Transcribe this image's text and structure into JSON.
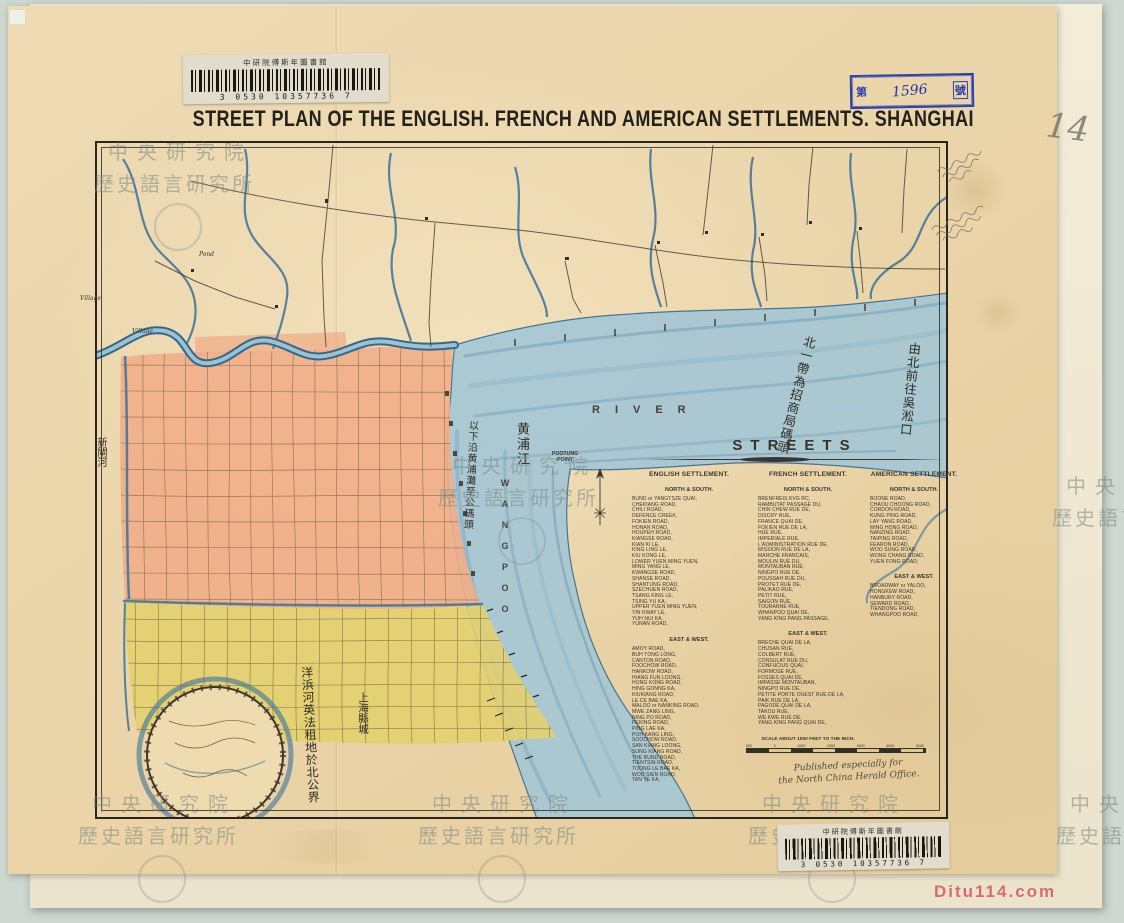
{
  "library": {
    "label": "中研院傅斯年圖書館",
    "barcode_number": "3 0530 10357736 7",
    "stamp": {
      "prefix": "第",
      "number": "1596",
      "suffix": "號"
    },
    "page_pencil_number": "14",
    "watermark": {
      "line1": "中央研究院",
      "line2": "歷史語言研究所"
    },
    "site_credit": "Ditu114.com"
  },
  "map": {
    "title": "STREET PLAN OF THE ENGLISH. FRENCH AND AMERICAN SETTLEMENTS. SHANGHAI",
    "labels": {
      "river": "RIVER",
      "wangpoo": "WANGPOO",
      "pootung_point": "POOTUNG POINT",
      "pond": "Pond",
      "village_1": "Village",
      "village_2": "Village"
    },
    "chinese_annotations": {
      "huangpu_river": "黄浦江",
      "wharf_note": "北一帶為招商局碼頭",
      "woosung_note": "由北前往吳淞口",
      "bund_note": "以下沿黄浦灘至公碼頭",
      "boundary_note": "洋浜河英法租地於北公界",
      "walled_city": "上海縣城",
      "soochow_creek": "新閘河"
    },
    "streets_panel": {
      "heading": "STREETS",
      "north_south_label": "NORTH & SOUTH.",
      "east_west_label": "EAST & WEST.",
      "columns": [
        {
          "name": "ENGLISH SETTLEMENT.",
          "north_south": [
            "BUND or YANGTSZE QUAI,",
            "CHEKIANG ROAD,",
            "CHILI ROAD,",
            "DEFENCE CREEK,",
            "FOKIEN ROAD,",
            "HONAN ROAD,",
            "HOUPEH ROAD,",
            "KIANGSE ROAD,",
            "KIAN KI LE,",
            "KING LING LE,",
            "KIU KONG LE,",
            "LOWER YUEN MING YUEN,",
            "MING YANG LE,",
            "KWANGSE ROAD,",
            "SHANSE ROAD,",
            "SHANTUNG ROAD,",
            "SZECHUEN ROAD,",
            "TSANG KING LE,",
            "TSING YU KA,",
            "UPPER YUEN MING YUEN,",
            "YIN KWAY LE,",
            "YUH NUI KA,",
            "YUNAN ROAD,"
          ],
          "east_west": [
            "AMOY ROAD,",
            "BUH TONG LONG,",
            "CANTON ROAD,",
            "FOOCHOW ROAD,",
            "HANKOW ROAD,",
            "HIANG FUN LOONG,",
            "HONG KONG ROAD,",
            "HING GONNG KA,",
            "KIUKIANG ROAD,",
            "LE CE BAE KA,",
            "MALOO or NANKING ROAD,",
            "MWE ZANG LING,",
            "NING PO ROAD,",
            "PEKING ROAD,",
            "PING LAE KA,",
            "POH KANG LING,",
            "SOOCHOW ROAD,",
            "SAN KIANG LOONG,",
            "SUNG KIANG ROAD,",
            "THE BUND ROAD,",
            "TIENTSIN ROAD,",
            "TOONG LE BAE KA,",
            "WOO SIEN ROAD,",
            "TAN YE KA,"
          ]
        },
        {
          "name": "FRENCH SETTLEMENT.",
          "north_south": [
            "BRENFREIS KVG RC,",
            "RAMBUTAT PASSAGE DU,",
            "CHIN CHEW RUE DE,",
            "DISCRY RUE,",
            "FRANCE QUAI DE,",
            "FOKIEN RUE DE LA,",
            "HUE RUE,",
            "IMPERIALE RUE,",
            "L'ADMINISTRATION RUE DE,",
            "MISSION RUE DE LA,",
            "MARCHE FRANCAIS,",
            "MOULIN RUE DU,",
            "MONTAUBAN RUE,",
            "NINGPO RUE DE,",
            "POUSSAH RUE DU,",
            "PROTET RUE DE,",
            "PALIKAO RUE,",
            "PETIT RUE,",
            "SAIGON RUE,",
            "TOURANNE RUE,",
            "WHANPOO QUAI DE,",
            "YANG KING PANG PASSAGE,"
          ],
          "east_west": [
            "BRECHE QUAI DE LA,",
            "CHUSAN RUE,",
            "COLBERT RUE,",
            "CONSULAT RUE DU,",
            "CONFUCIUS QUAI,",
            "FORMOSE RUE,",
            "FOSSES QUAI DE,",
            "IMPASSE MONTAUBAN,",
            "NINGPO RUE DE,",
            "PETITE PORTE OUEST RUE DE LA,",
            "PAIK RUE DE LA,",
            "PAGODE QUAI DE LA,",
            "TAKOU RUE,",
            "WE KWE RUE DE,",
            "YANG KING PANG QUAI DE,"
          ]
        },
        {
          "name": "AMERICAN SETTLEMENT.",
          "north_south": [
            "BOONE ROAD,",
            "CHAOU CHOONG ROAD,",
            "CORDON ROAD,",
            "KUNG PING ROAD,",
            "LAY YANG ROAD,",
            "MING HONG ROAD,",
            "NANZING ROAD,",
            "TAIPING ROAD,",
            "FEARON ROAD,",
            "WOO SUNG ROAD,",
            "WONG CHANG ROAD,",
            "YUEN FONG ROAD,"
          ],
          "east_west": [
            "BROADWAY or YALOO,",
            "HONGKEW ROAD,",
            "HANBURY ROAD,",
            "SEWARD ROAD,",
            "TIENDONG ROAD,",
            "WHANGPOO ROAD,"
          ]
        }
      ],
      "scale_note": "SCALE ABOUT 1050 FEET TO THE INCH.",
      "scale_ticks": [
        "500",
        "0",
        "1000",
        "2000",
        "3000",
        "4000",
        "5000"
      ],
      "publisher_note": [
        "Published especially for",
        "the North China Herald Office."
      ]
    },
    "colors": {
      "english_settlement": "#efae88",
      "french_settlement": "#e2d06e",
      "river": "#a8c8d4",
      "paper": "#ead5ab",
      "stamp_blue": "#2d3fb0"
    }
  }
}
